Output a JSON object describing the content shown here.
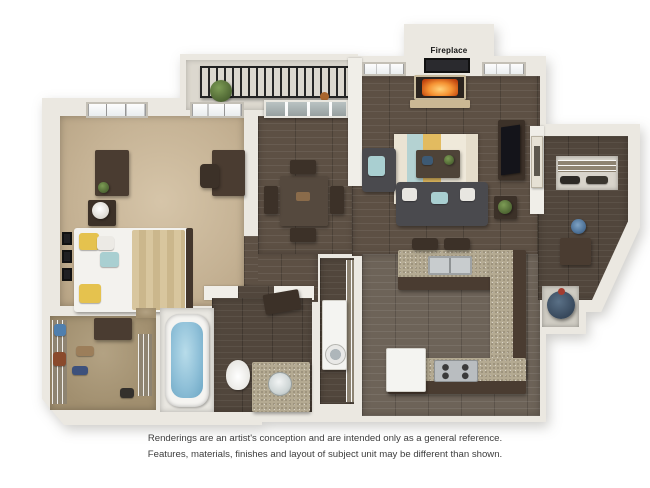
{
  "labels": {
    "fireplace": "Fireplace"
  },
  "disclaimer": {
    "line1": "Renderings are an artist's conception and are intended only as a general reference.",
    "line2": "Features, materials, finishes and layout of subject unit may be different than shown."
  },
  "colors": {
    "background": "#ffffff",
    "wall": "#ebe8e1",
    "wall_shade": "#d8d4cb",
    "bedroom_carpet": "#c5b294",
    "closet_carpet": "#a89878",
    "wood_floor": "#5d5044",
    "wood_floor_gray": "#6d6358",
    "wood_floor_bath": "#51463c",
    "granite_counter": "#b4aa92",
    "cabinet_dark": "#4a3c31",
    "sofa_gray": "#4a4a4e",
    "rug_cream": "#eae3d3",
    "rug_teal": "#b4d2d2",
    "rug_yellow": "#e2bb60",
    "pillow_yellow": "#e5c24e",
    "pillow_teal": "#a9cfd1",
    "bed_blanket": "#d8c69e",
    "tub_water": "#8fc0d8",
    "fire_orange": "#e07820",
    "railing_black": "#262626",
    "water_heater_blue": "#3c4e62",
    "appliance_white": "#f4f4f1",
    "disclaimer_text": "#3d3d3d"
  }
}
